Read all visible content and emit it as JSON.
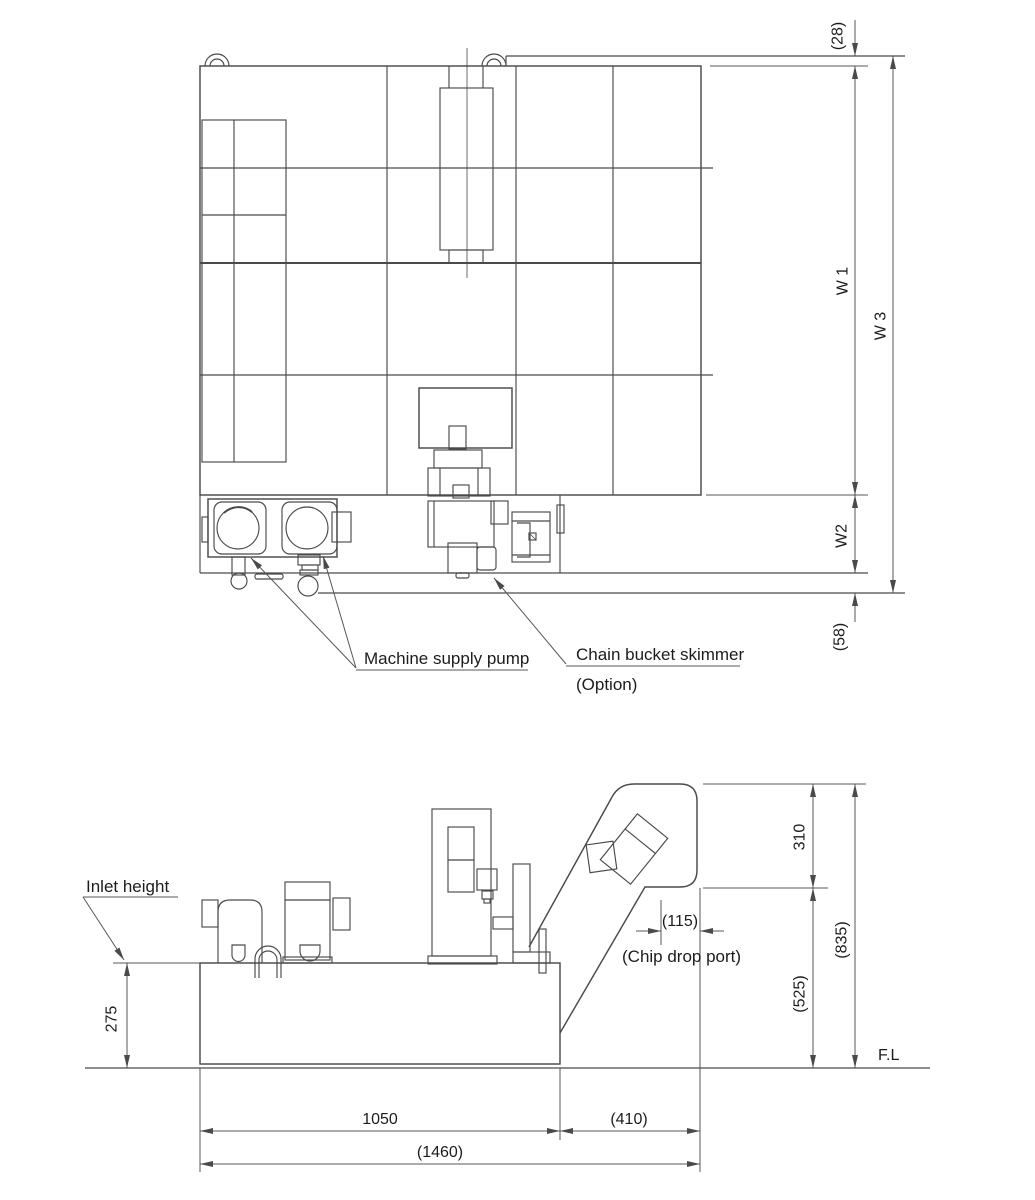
{
  "title": "Coolant tank with chip conveyor - dimensional drawing",
  "top_view": {
    "dim_28": "(28)",
    "dim_w1": "W 1",
    "dim_w3": "W 3",
    "dim_w2": "W2",
    "dim_58": "(58)",
    "label_pump": "Machine supply pump",
    "label_skimmer": "Chain bucket skimmer",
    "label_skimmer_option": "(Option)"
  },
  "side_view": {
    "label_inlet_height": "Inlet height",
    "dim_275": "275",
    "dim_310": "310",
    "dim_835": "(835)",
    "dim_525": "(525)",
    "dim_115": "(115)",
    "label_chip_drop_port": "(Chip drop port)",
    "label_floor": "F.L",
    "dim_1050": "1050",
    "dim_410": "(410)",
    "dim_1460": "(1460)"
  },
  "colors": {
    "line": "#4a4a4a",
    "dimension_line": "#575757",
    "text": "#1c1c1c",
    "background": "#ffffff"
  }
}
